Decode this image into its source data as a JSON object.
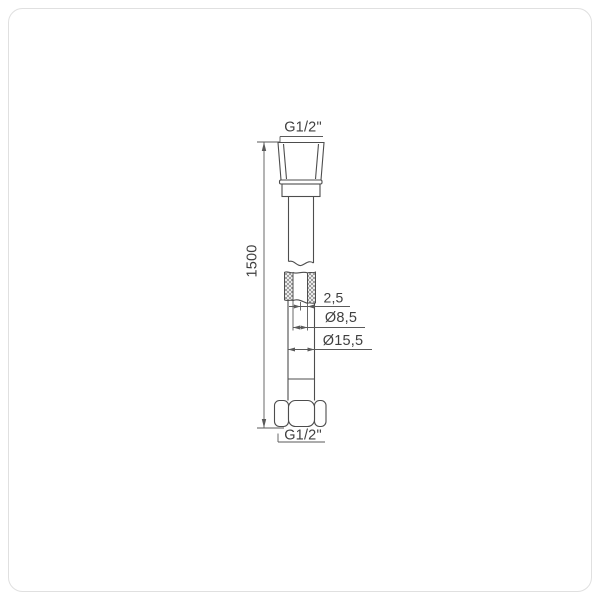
{
  "page": {
    "background": "#ffffff",
    "frame_color": "#e0e0e0"
  },
  "drawing": {
    "name": "Shower hose technical drawing",
    "labels": {
      "top_thread": "G1/2\"",
      "length": "1500",
      "wall_thickness": "2,5",
      "inner_diameter": "Ø8,5",
      "outer_diameter": "Ø15,5",
      "bottom_thread": "G1/2\""
    },
    "values": {
      "length_mm": 1500,
      "wall_thickness_mm": 2.5,
      "inner_diameter_mm": 8.5,
      "outer_diameter_mm": 15.5,
      "thread_size": "G1/2\""
    },
    "colors": {
      "object_line": "#4d4d4d",
      "dimension_line": "#5a5a5a",
      "text": "#3f3f3f",
      "hatch": "#8a8a8a"
    }
  }
}
